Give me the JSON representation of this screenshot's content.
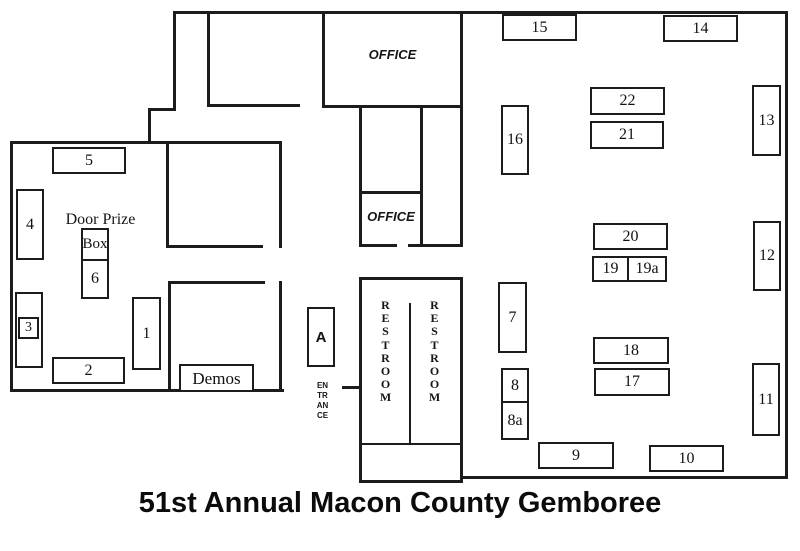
{
  "title": "51st Annual Macon County Gemboree",
  "labels": {
    "office_main": "OFFICE",
    "office_small": "OFFICE",
    "restroom_left": "RESTROOM",
    "restroom_right": "RESTROOM",
    "entrance_marker": "A",
    "entrance": "ENTRANCE",
    "door_prize_line": "Door Prize",
    "door_prize_box": "Box",
    "demos": "Demos"
  },
  "booths": {
    "b1": "1",
    "b2": "2",
    "b3": "3",
    "b4": "4",
    "b5": "5",
    "b6": "6",
    "b7": "7",
    "b8": "8",
    "b8a": "8a",
    "b9": "9",
    "b10": "10",
    "b11": "11",
    "b12": "12",
    "b13": "13",
    "b14": "14",
    "b15": "15",
    "b16": "16",
    "b17": "17",
    "b18": "18",
    "b19": "19",
    "b19a": "19a",
    "b20": "20",
    "b21": "21",
    "b22": "22"
  },
  "ink_color": "#1c1c1c",
  "background_color": "#ffffff"
}
